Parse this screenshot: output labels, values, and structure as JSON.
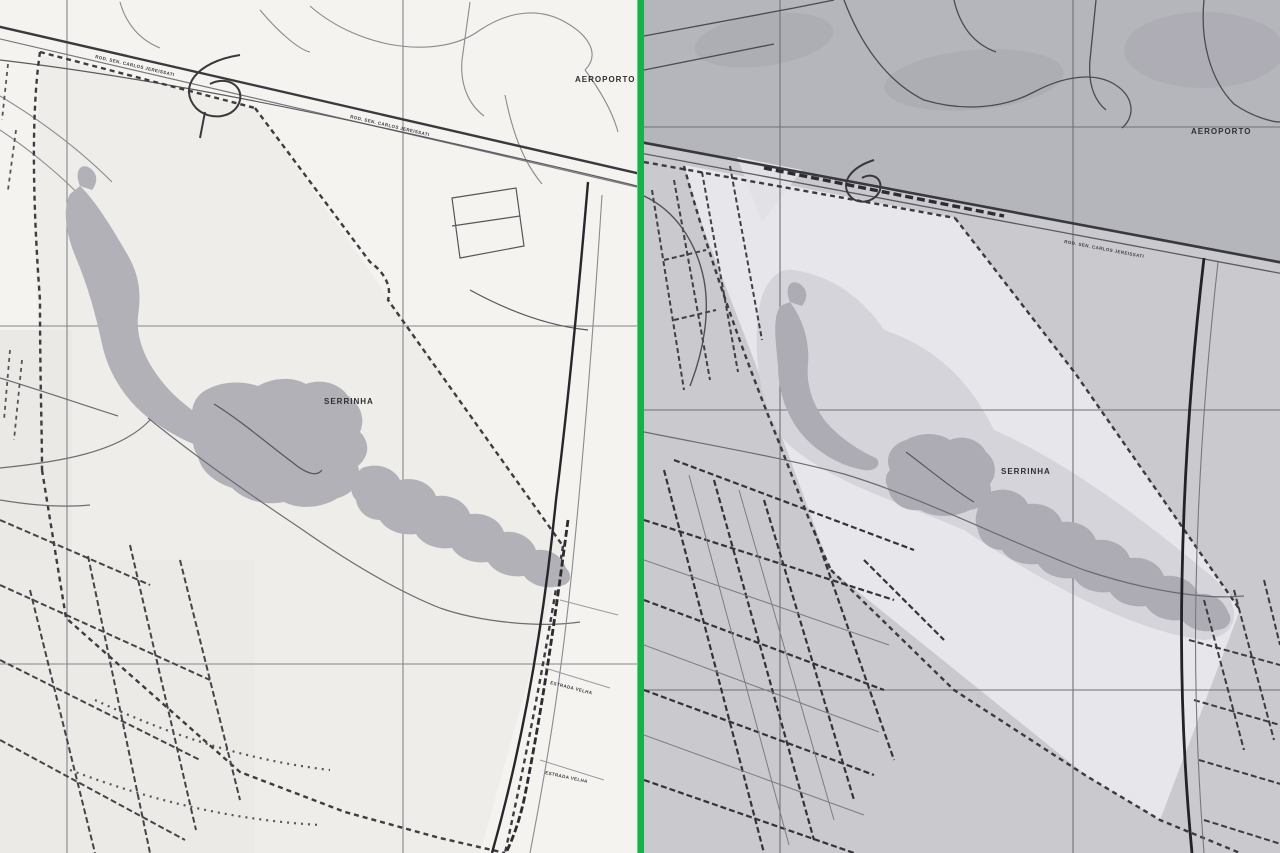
{
  "figure": {
    "type": "side-by-side scanned map comparison",
    "region": "Serrinha / airport area, two scans of the same topographic map",
    "divider_color": "#17b04b"
  },
  "left_map": {
    "description": "lighter scan of the map",
    "paper_color": "#f4f3ef",
    "blob_gray": "#b2b1b8",
    "labels": {
      "aeroporto": "AEROPORTO",
      "serrinha": "SERRINHA",
      "highway_illegible": "ROD. SEN. CARLOS JEREISSATI",
      "street_label_1_illegible": "ESTRADA VELHA",
      "street_label_2_illegible": "ESTRADA VELHA"
    }
  },
  "right_map": {
    "description": "darker scan of the same map",
    "paper_color": "#c9c9ce",
    "dark_zone_color": "#b5b5bc",
    "campus_light_color": "#e7e6eb",
    "blob_gray": "#adacb4",
    "labels": {
      "aeroporto": "AEROPORTO",
      "serrinha": "SERRINHA",
      "highway_illegible": "ROD. SEN. CARLOS JEREISSATI"
    }
  }
}
